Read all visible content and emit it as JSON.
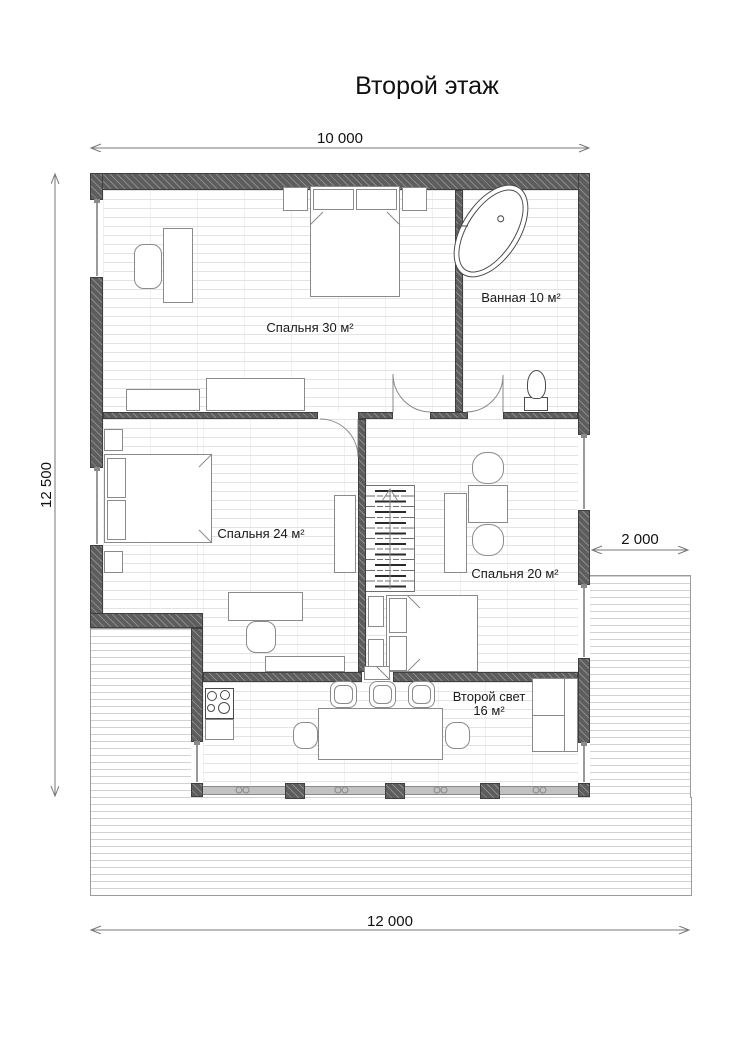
{
  "title": "Второй этаж",
  "dimensions": {
    "top": "10 000",
    "left": "12 500",
    "right": "2 000",
    "bottom": "12 000"
  },
  "rooms": {
    "bedroom30": {
      "label": "Спальня 30 м²"
    },
    "bathroom": {
      "label": "Ванная 10 м²"
    },
    "bedroom24": {
      "label": "Спальня 24 м²"
    },
    "bedroom20": {
      "label": "Спальня 20 м²"
    },
    "secondlight": {
      "label_line1": "Второй свет",
      "label_line2": "16 м²"
    }
  },
  "colors": {
    "wall": "#5d5d5d",
    "floor_line": "#e3e3e3",
    "deck_line": "#d2d2d2",
    "dim": "#777777",
    "furniture": "#8a8a8a",
    "text": "#1a1a1a"
  }
}
